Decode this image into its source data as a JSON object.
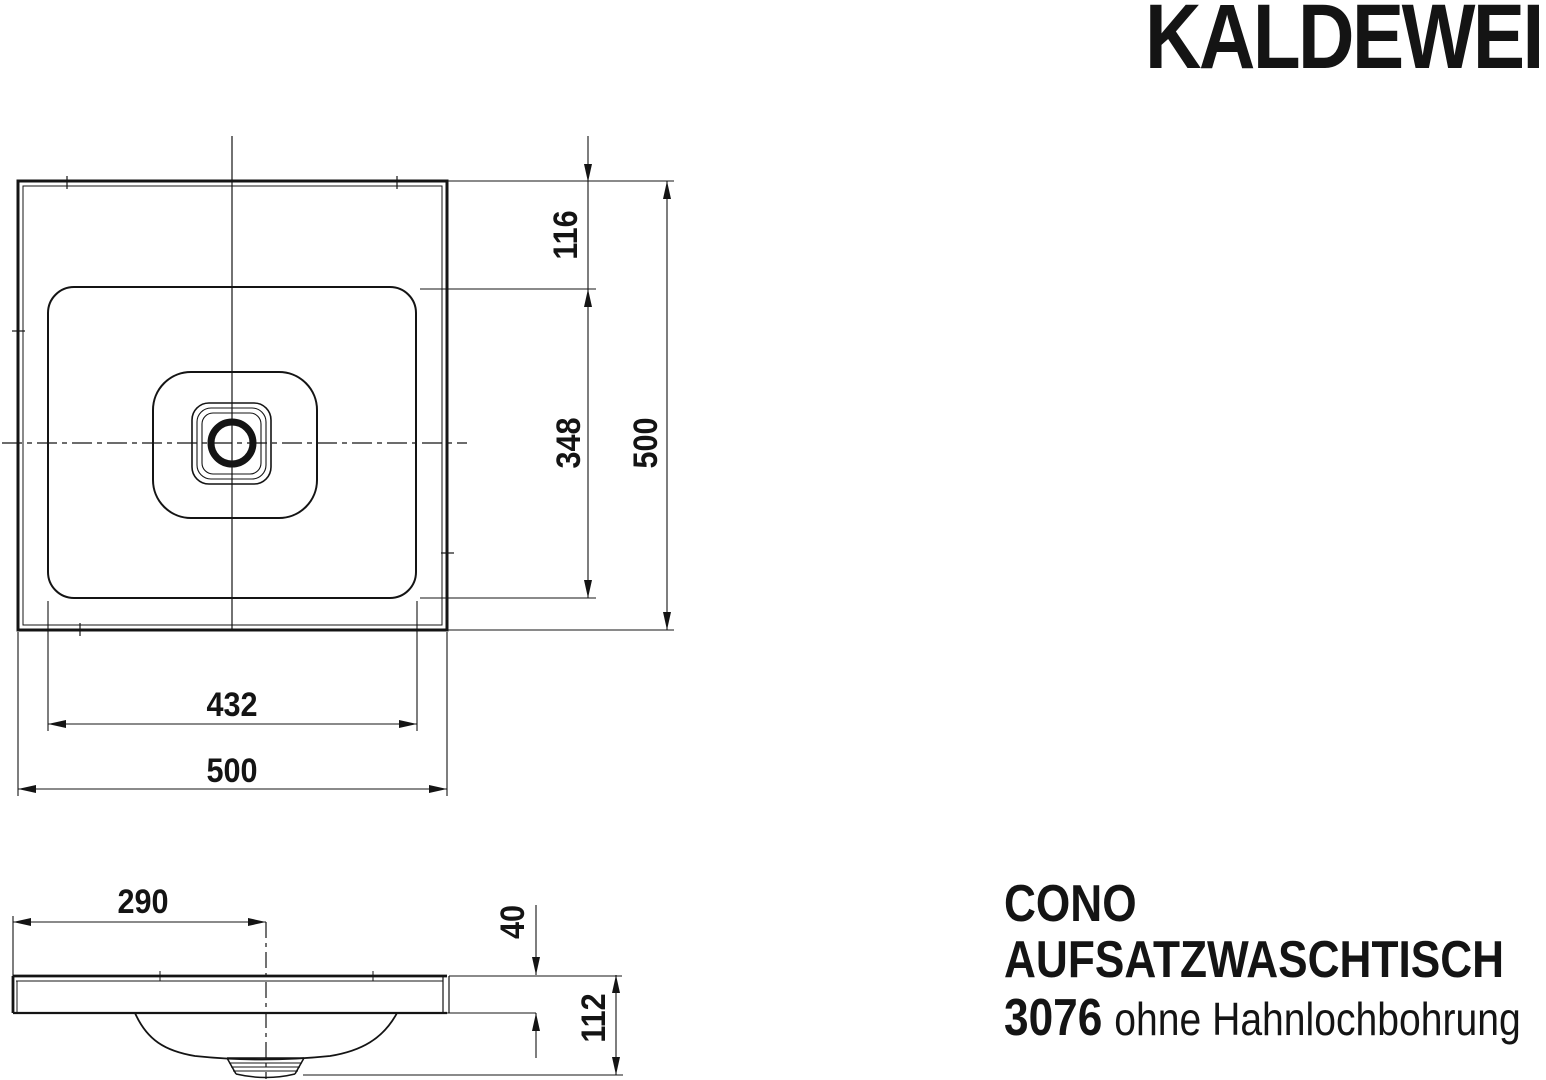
{
  "brand": {
    "logo_text": "KALDEWEI"
  },
  "product": {
    "series": "CONO",
    "type": "AUFSATZWASCHTISCH",
    "model_number": "3076",
    "variant_note": "ohne Hahnlochbohrung"
  },
  "plan_view": {
    "dim_rim_to_basin_top": "116",
    "dim_basin_depth": "348",
    "dim_overall_height": "500",
    "dim_basin_width": "432",
    "dim_overall_width": "500"
  },
  "section_view": {
    "dim_left_edge_to_drain": "290",
    "dim_rim_thickness": "40",
    "dim_overall_depth": "112"
  },
  "colors": {
    "ink": "#141414",
    "background": "#ffffff"
  }
}
